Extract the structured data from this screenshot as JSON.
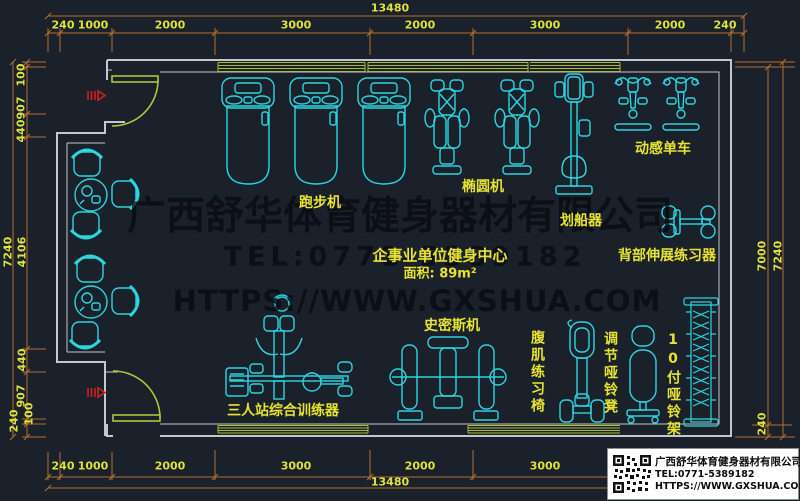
{
  "colors": {
    "background": "#1a212b",
    "equipment_line": "#2bd6e0",
    "dimension_line": "#b4702c",
    "dimension_text": "#dde23c",
    "label_text": "#e6e332",
    "wall_line": "#c3c8cd",
    "window_line": "#a9bf2f",
    "door_line": "#a9c93c",
    "entrance_arrow": "#d41f1f",
    "watermark_text": "rgba(8,10,14,0.74)"
  },
  "dimensions": {
    "top": {
      "total": "13480",
      "segments": [
        "240",
        "1000",
        "2000",
        "3000",
        "2000",
        "3000",
        "2000",
        "240"
      ]
    },
    "bottom": {
      "total": "13480",
      "segments": [
        "240",
        "1000",
        "2000",
        "3000",
        "2000",
        "3000"
      ]
    },
    "left": {
      "total": "7240",
      "segments": [
        "100",
        "907",
        "440",
        "4106",
        "440",
        "907",
        "100",
        "240"
      ]
    },
    "right": {
      "total": "7240",
      "inner": "7000",
      "wall": "240"
    }
  },
  "room": {
    "name": "企事业单位健身中心",
    "area": "面积: 89m²"
  },
  "equipment": {
    "treadmill": "跑步机",
    "elliptical": "椭圆机",
    "rowing": "划船器",
    "spin_bike": "动感单车",
    "back_extension": "背部伸展练习器",
    "smith_machine": "史密斯机",
    "multi_station": "三人站综合训练器",
    "ab_chair": "腹肌练习椅",
    "dumbbell_bench": "调节哑铃凳",
    "dumbbell_rack": "10付哑铃架"
  },
  "watermark": {
    "company": "广西舒华体育健身器材有限公司",
    "tel": "TEL:0771-5389182",
    "url": "HTTPS://WWW.GXSHUA.COM"
  },
  "title_block": {
    "company": "广西舒华体育健身器材有限公司",
    "tel": "TEL:0771-5389182",
    "url": "HTTPS://WWW.GXSHUA.COM"
  }
}
